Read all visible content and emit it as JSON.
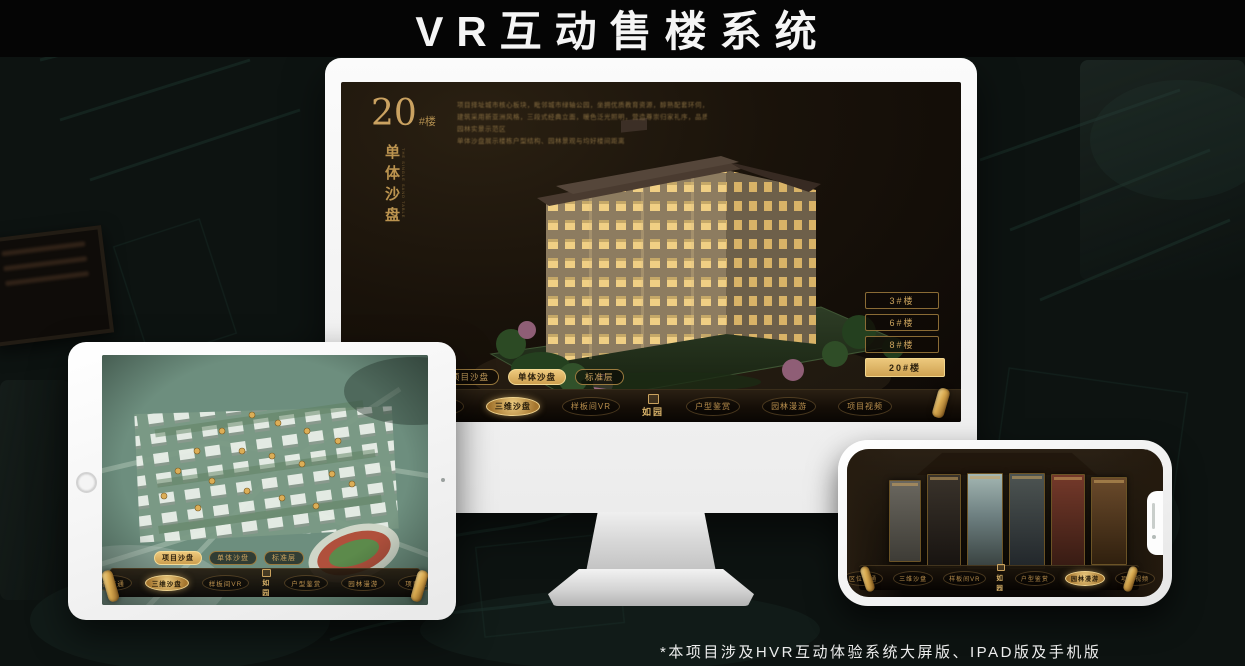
{
  "page": {
    "title": "VR互动售楼系统",
    "footnote": "*本项目涉及HVR互动体验系统大屏版、IPAD版及手机版"
  },
  "colors": {
    "gold": "#d2a963",
    "gold_highlight": "#eec97d",
    "screen_bg": "#19120a",
    "page_bg": "#0d1311"
  },
  "monitor": {
    "headline": {
      "number": "20",
      "suffix": "#楼",
      "vertical": "单体沙盘",
      "caption_en": "THE SINGLE SAND TABLE"
    },
    "description_lines": [
      "项目择址城市核心板块，毗邻城市绿轴公园，坐拥优质教育资源，醇熟配套环伺，尽享都会繁华",
      "建筑采用新亚洲风格，三段式经典立面，暖色泛光照明，营造尊崇归家礼序，品质细节处处考究",
      "园林实景示范区",
      "单体沙盘展示楼栋户型结构、园林景观与均好楼间距离"
    ],
    "floor_buttons": [
      {
        "label": "3#楼"
      },
      {
        "label": "6#楼"
      },
      {
        "label": "8#楼"
      },
      {
        "label": "20#楼"
      }
    ],
    "sub_tabs": [
      {
        "label": "项目沙盘"
      },
      {
        "label": "单体沙盘"
      },
      {
        "label": "标准层"
      }
    ],
    "nav": {
      "items_left": [
        "区位交通",
        "三维沙盘",
        "样板间VR"
      ],
      "items_right": [
        "户型鉴赏",
        "园林漫游",
        "项目视频"
      ],
      "logo": "如园"
    }
  },
  "tablet": {
    "sub_tabs": [
      {
        "label": "项目沙盘"
      },
      {
        "label": "单体沙盘"
      },
      {
        "label": "标准层"
      }
    ],
    "nav": {
      "items_left": [
        "区位交通",
        "三维沙盘",
        "样板间VR"
      ],
      "items_right": [
        "户型鉴赏",
        "园林漫游",
        "项目视频"
      ],
      "logo": "如园"
    }
  },
  "phone": {
    "nav": {
      "items_left": [
        "区位交通",
        "三维沙盘",
        "样板间VR"
      ],
      "items_right": [
        "户型鉴赏",
        "园林漫游",
        "项目视频"
      ],
      "logo": "如园"
    }
  }
}
